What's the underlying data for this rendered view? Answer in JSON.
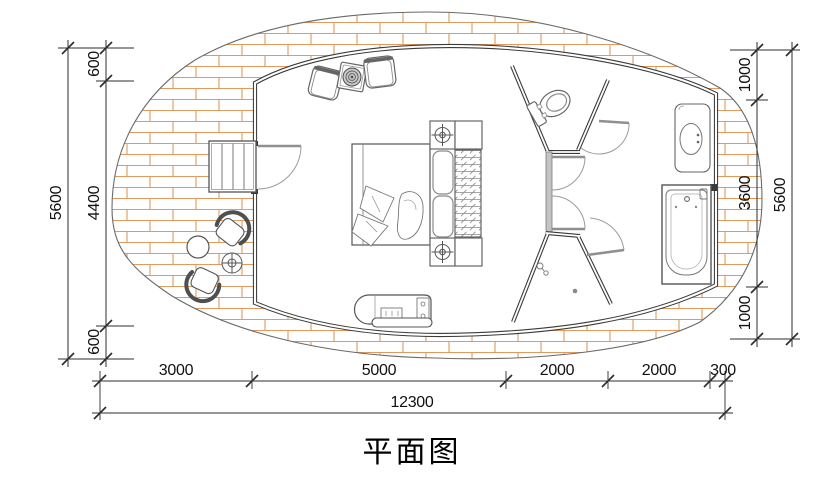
{
  "title": "平面图",
  "drawing": {
    "type": "floor-plan",
    "dimensions": {
      "left": {
        "total": "5600",
        "segments": [
          "600",
          "4400",
          "600"
        ]
      },
      "right": {
        "total": "5600",
        "segments": [
          "1000",
          "3600",
          "1000"
        ]
      },
      "bottom": {
        "total": "12300",
        "segments": [
          "3000",
          "5000",
          "2000",
          "2000",
          "300"
        ]
      }
    },
    "colors": {
      "deck_plank": "#e09a5b",
      "wall": "#3a3a3a",
      "furniture_line": "#6f6f6f",
      "dimension_line": "#2e2e2e"
    },
    "icons": [
      "entry-stairs-icon",
      "entry-door-icon",
      "double-bed-icon",
      "bed-pillow-icon",
      "wardrobe-hangers-icon",
      "column-target-icon",
      "armchair-icon",
      "round-tray-table-icon",
      "tv-cabinet-icon",
      "toilet-icon",
      "washbasin-icon",
      "bathtub-icon",
      "floor-drain-icon",
      "shower-head-icon",
      "outdoor-chair-icon",
      "outdoor-round-table-icon",
      "outdoor-side-table-icon",
      "door-swing-icon"
    ]
  }
}
